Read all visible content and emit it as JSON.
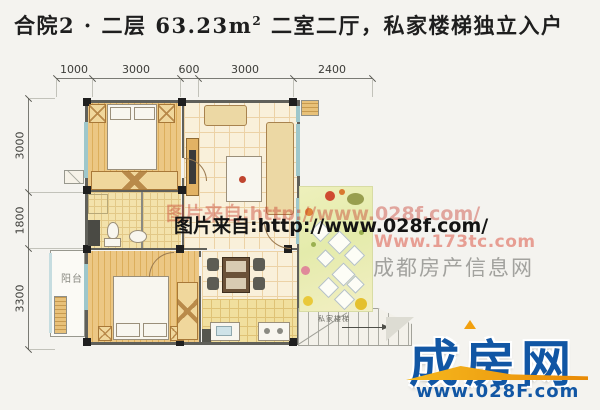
{
  "title": {
    "part1": "合院2 · 二层  63.23m",
    "sup": "2",
    "part2": "  二室二厅，私家楼梯独立入户"
  },
  "dims": {
    "top": [
      "1000",
      "3000",
      "600",
      "3000",
      "2400"
    ],
    "left": [
      "3000",
      "1800",
      "3300"
    ]
  },
  "plan": {
    "balcony_label": "阳台",
    "stairs_label": "私家楼梯"
  },
  "watermarks": {
    "shadow": "图片来自:http://www.028f.com/",
    "main": "图片来自:http://www.028f.com/",
    "site_url": "Www.173tc.com",
    "site_name": "成都房产信息网"
  },
  "logo": {
    "name": "成房网",
    "url": "www.028F.com"
  },
  "colors": {
    "logo_blue": "#1156a4",
    "swoosh_orange": "#ee9410",
    "watermark_pink": "#e79e93",
    "watermark_gray": "#a2a29e",
    "window_teal": "#9ec7cb",
    "wood_floor": "#ecc784"
  }
}
